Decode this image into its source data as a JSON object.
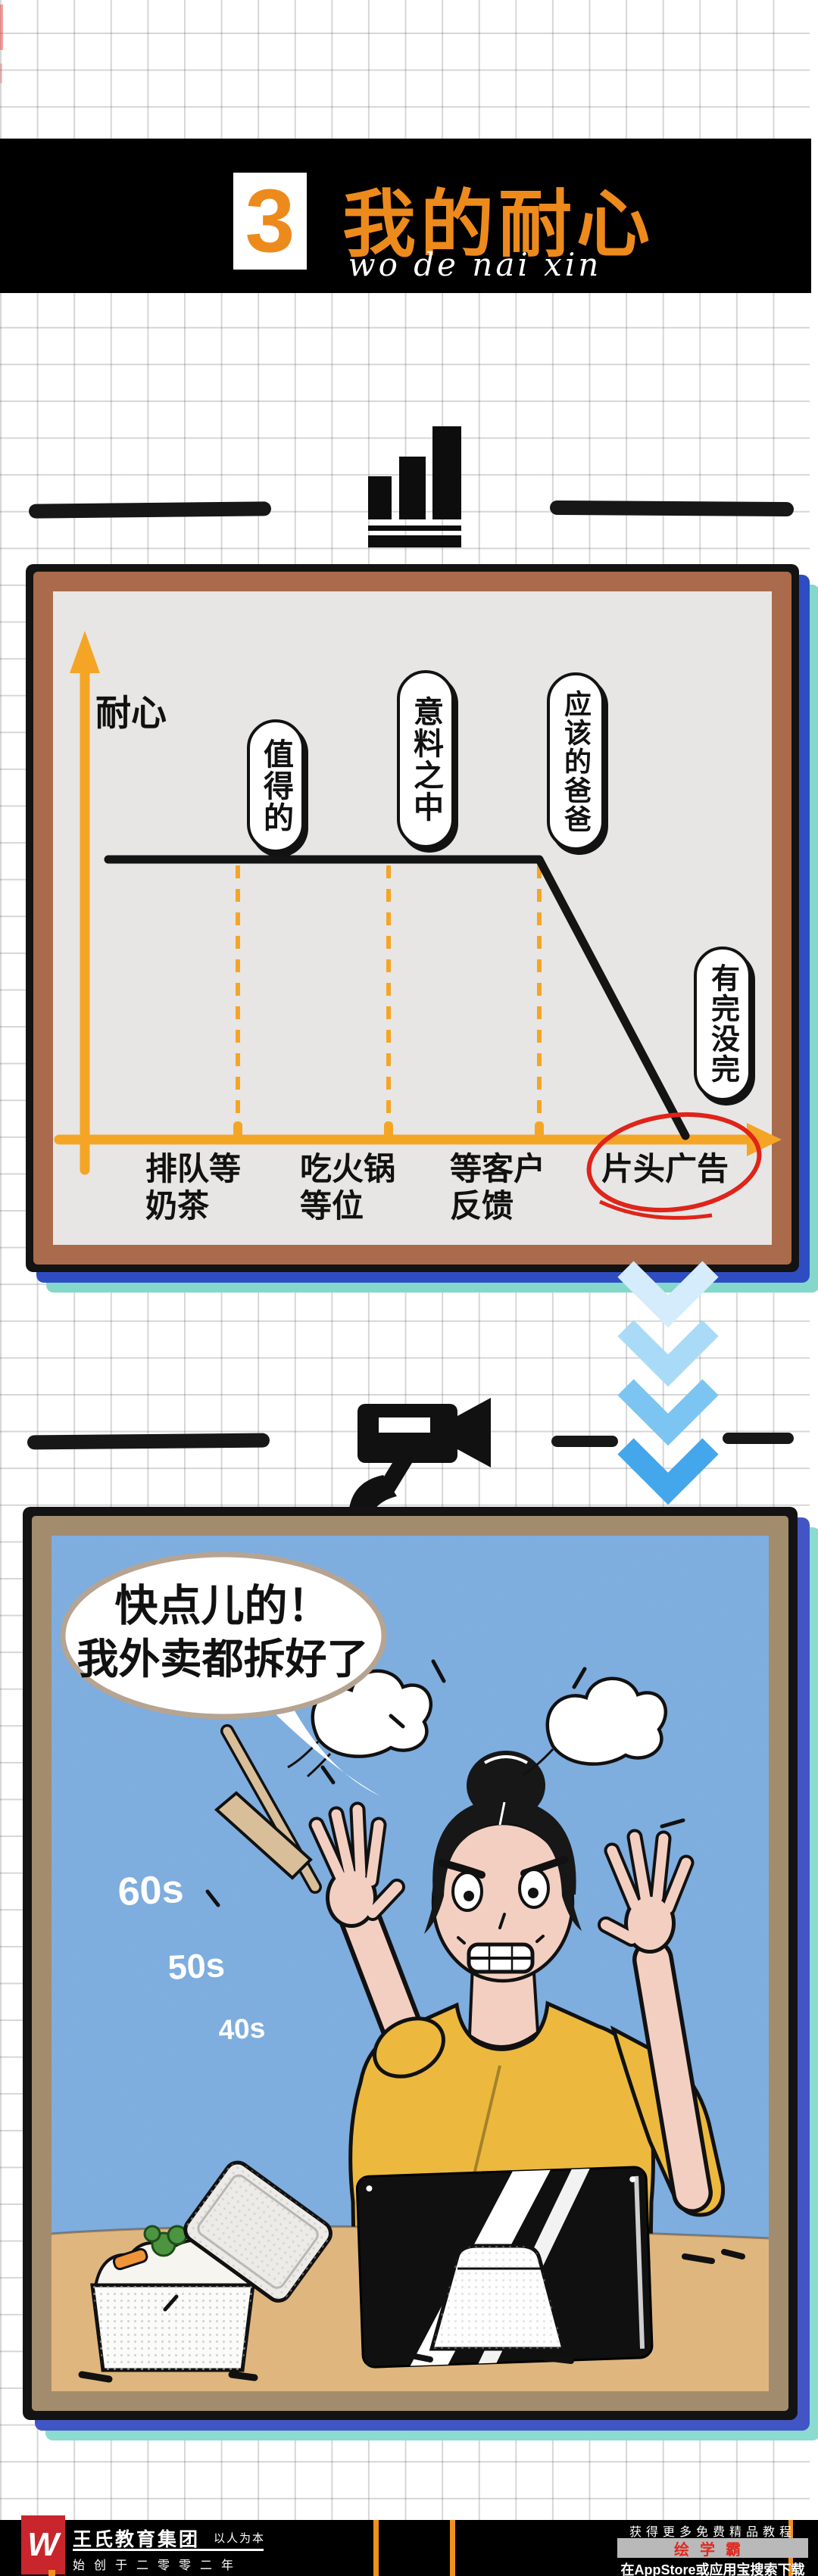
{
  "header": {
    "section_number": "3",
    "title": "我的耐心",
    "subtitle": "wo de nai xin",
    "banner_bg": "#000000",
    "accent": "#ed8a1c",
    "number_box_bg": "#ffffff"
  },
  "chart_data": {
    "type": "line",
    "title": "",
    "ylabel": "耐心",
    "xlabel": "",
    "categories": [
      "排队等奶茶",
      "吃火锅等位",
      "等客户反馈",
      "片头广告"
    ],
    "x_tick_labels": [
      {
        "line1": "排队等",
        "line2": "奶茶"
      },
      {
        "line1": "吃火锅",
        "line2": "等位"
      },
      {
        "line1": "等客户",
        "line2": "反馈"
      },
      {
        "line1": "片头广告",
        "line2": ""
      }
    ],
    "values": [
      100,
      100,
      100,
      5
    ],
    "point_annotations": [
      "值得的",
      "意料之中",
      "应该的爸爸",
      "有完没完"
    ],
    "highlighted_category": "片头广告",
    "highlight_marker": "red-ellipse",
    "line_color": "#141414",
    "axis_color": "#f5a526",
    "ylim": [
      0,
      110
    ],
    "grid": false,
    "legend": false,
    "description": "耐心 stays at maximum while 排队等奶茶 / 吃火锅等位 / 等客户反馈, then plunges to near zero at 片头广告"
  },
  "transition": {
    "chevrons": 4,
    "chevron_colors": [
      "#d4ecfc",
      "#a9dbf8",
      "#7cc4f2",
      "#45a7eb"
    ]
  },
  "comic": {
    "bubble_line1": "快点儿的！",
    "bubble_line2": "我外卖都拆好了",
    "timers": [
      "60s",
      "50s",
      "40s"
    ],
    "sky": "#7cade0",
    "desk": "#e0b67f",
    "shirt": "#ecb93e",
    "skin": "#f3cfc2"
  },
  "footer": {
    "logo_letter": "W",
    "logo_bg": "#c9252c",
    "company": "王氏教育集团",
    "motto": "以人为本",
    "since": "始创于二零零二年",
    "promo_line1": "获得更多免费精品教程",
    "app_badge": "绘学霸",
    "promo_line2": "在AppStore或应用宝搜索下载"
  }
}
